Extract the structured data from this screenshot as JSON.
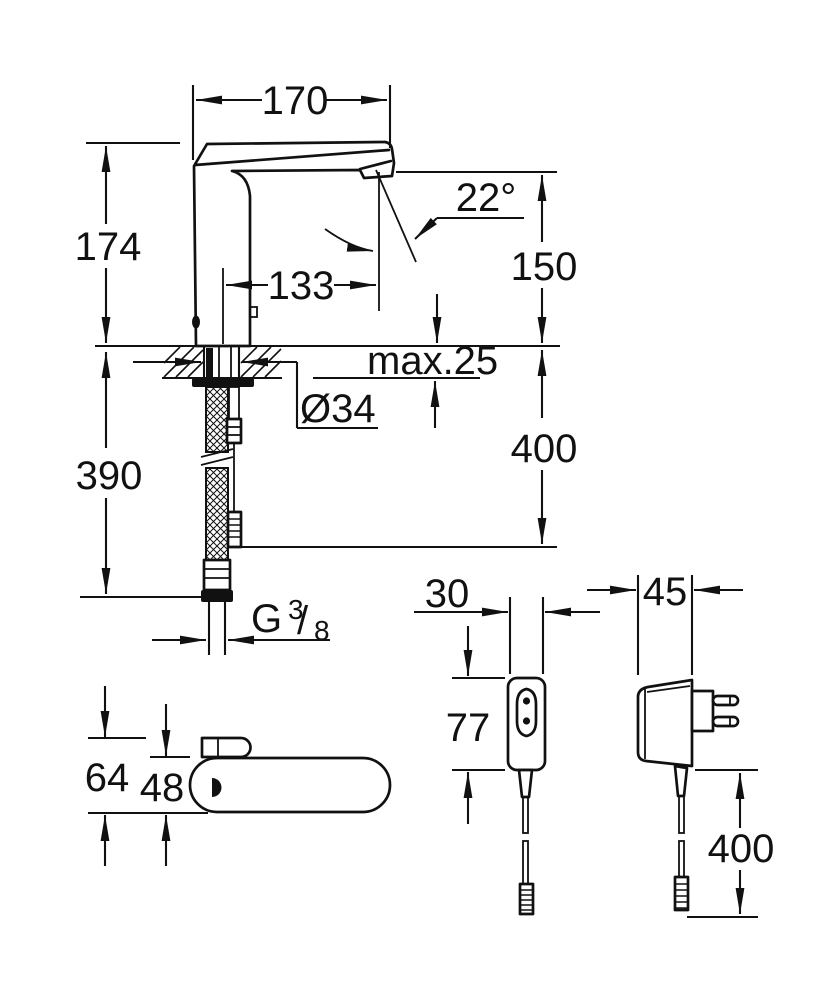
{
  "meta": {
    "drawing_type": "technical dimension drawing",
    "subject": "electronic sensor basin mixer with power supply and plug adapter"
  },
  "colors": {
    "line": "#111111",
    "background": "#ffffff"
  },
  "side_view": {
    "spout_length": "170",
    "height_above_deck": "174",
    "outlet_angle": "22°",
    "outlet_height": "150",
    "outlet_reach": "133",
    "deck_thickness": "max.25",
    "hole_diameter": "Ø34",
    "cable_below_deck_length": "400",
    "hose_below_deck_length": "390",
    "thread": {
      "g": "G",
      "numerator": "3",
      "slash": "/",
      "denominator": "8"
    }
  },
  "top_view": {
    "overall_depth": "64",
    "body_depth": "48"
  },
  "power_supply_front_view": {
    "width": "30",
    "height": "77"
  },
  "power_supply_side_view": {
    "depth": "45",
    "cable_length": "400"
  }
}
